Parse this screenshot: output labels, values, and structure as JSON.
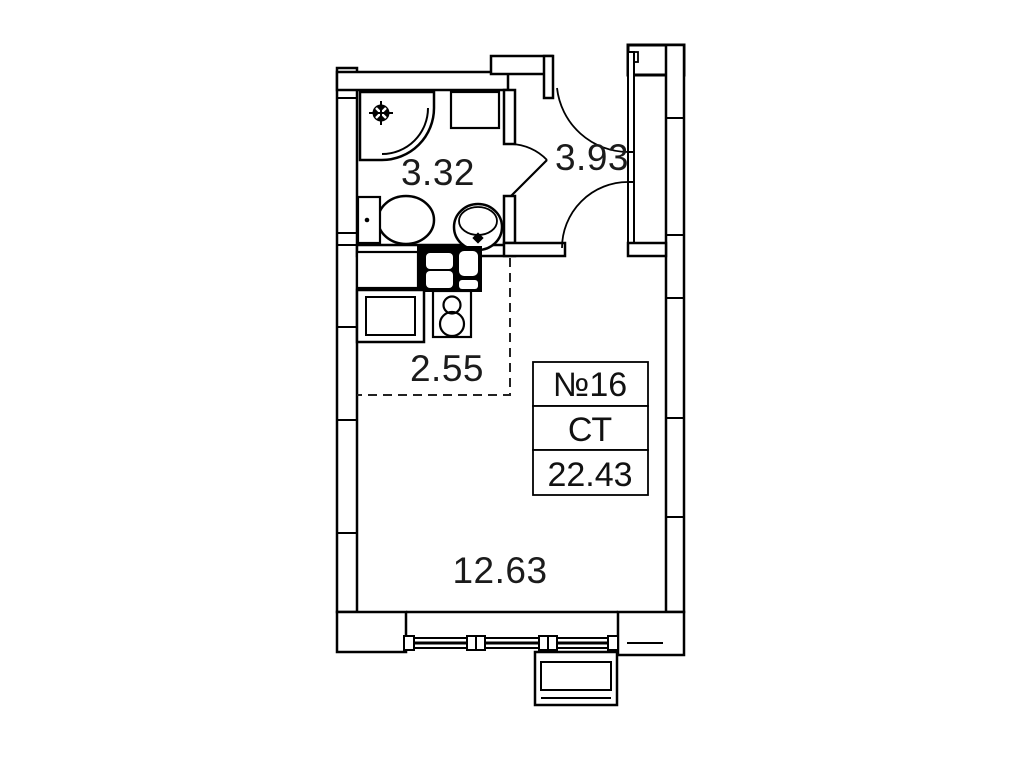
{
  "unit": {
    "number": "№16",
    "type": "СТ",
    "total_area": "22.43"
  },
  "rooms": {
    "bathroom": {
      "area": "3.32"
    },
    "hallway": {
      "area": "3.93"
    },
    "kitchen_zone": {
      "area": "2.55"
    },
    "living_room": {
      "area": "12.63"
    }
  },
  "fixtures": [
    "corner-shower",
    "shower-drain-icon",
    "storage-cabinet",
    "toilet",
    "washbasin",
    "kitchen-sink",
    "countertop",
    "washing-machine",
    "two-burner-stove",
    "triple-window",
    "ac-basket",
    "entrance-door-swing",
    "room-door-swing",
    "bathroom-door-swing"
  ],
  "colors": {
    "line": "#000000",
    "text": "#1b1b1b",
    "background": "#ffffff",
    "dashed_zone": "#222222"
  }
}
